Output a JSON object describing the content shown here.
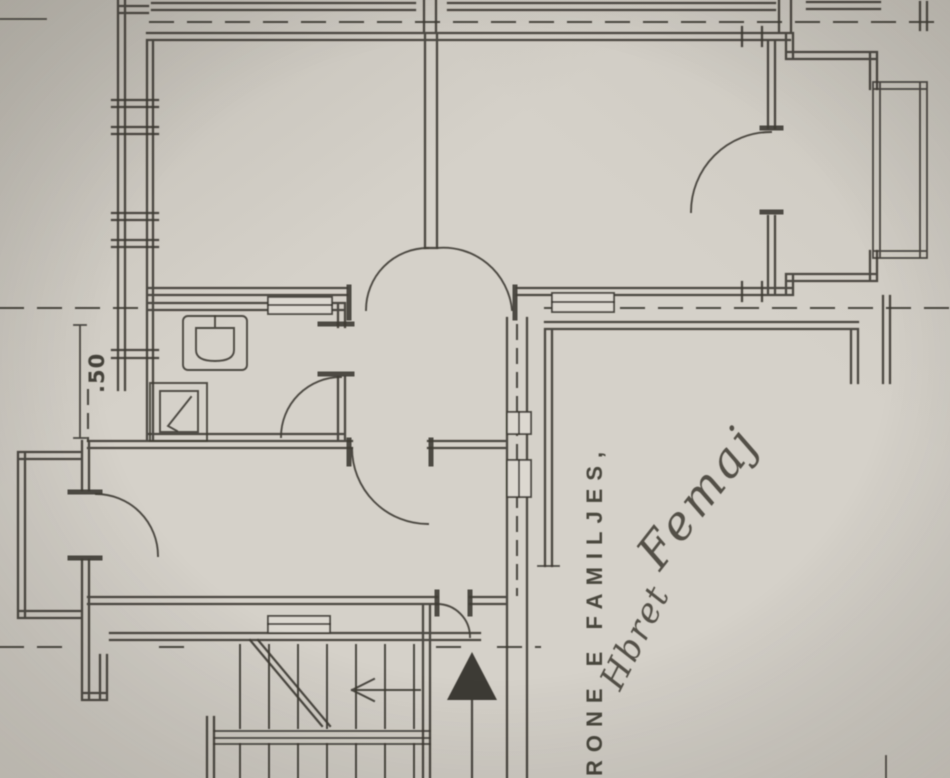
{
  "document": {
    "kind": "scanned-apartment-floor-plan",
    "annotations": {
      "dimension": ".50",
      "printed_caption": "RONE E FAMILJES,",
      "signature_first": "Hbret",
      "signature_last": "Femaj"
    },
    "symbols": {
      "entrance_arrow": "filled-triangle-up-arrow",
      "stair_direction_arrow": "left-arrow",
      "stair_break": "diagonal-break-line",
      "fixtures": [
        "washbasin",
        "shower-tray"
      ]
    },
    "colors": {
      "paper": "#d5d1c9",
      "paper_shadow": "#bab6ad",
      "ink": "#3e3b34"
    }
  }
}
